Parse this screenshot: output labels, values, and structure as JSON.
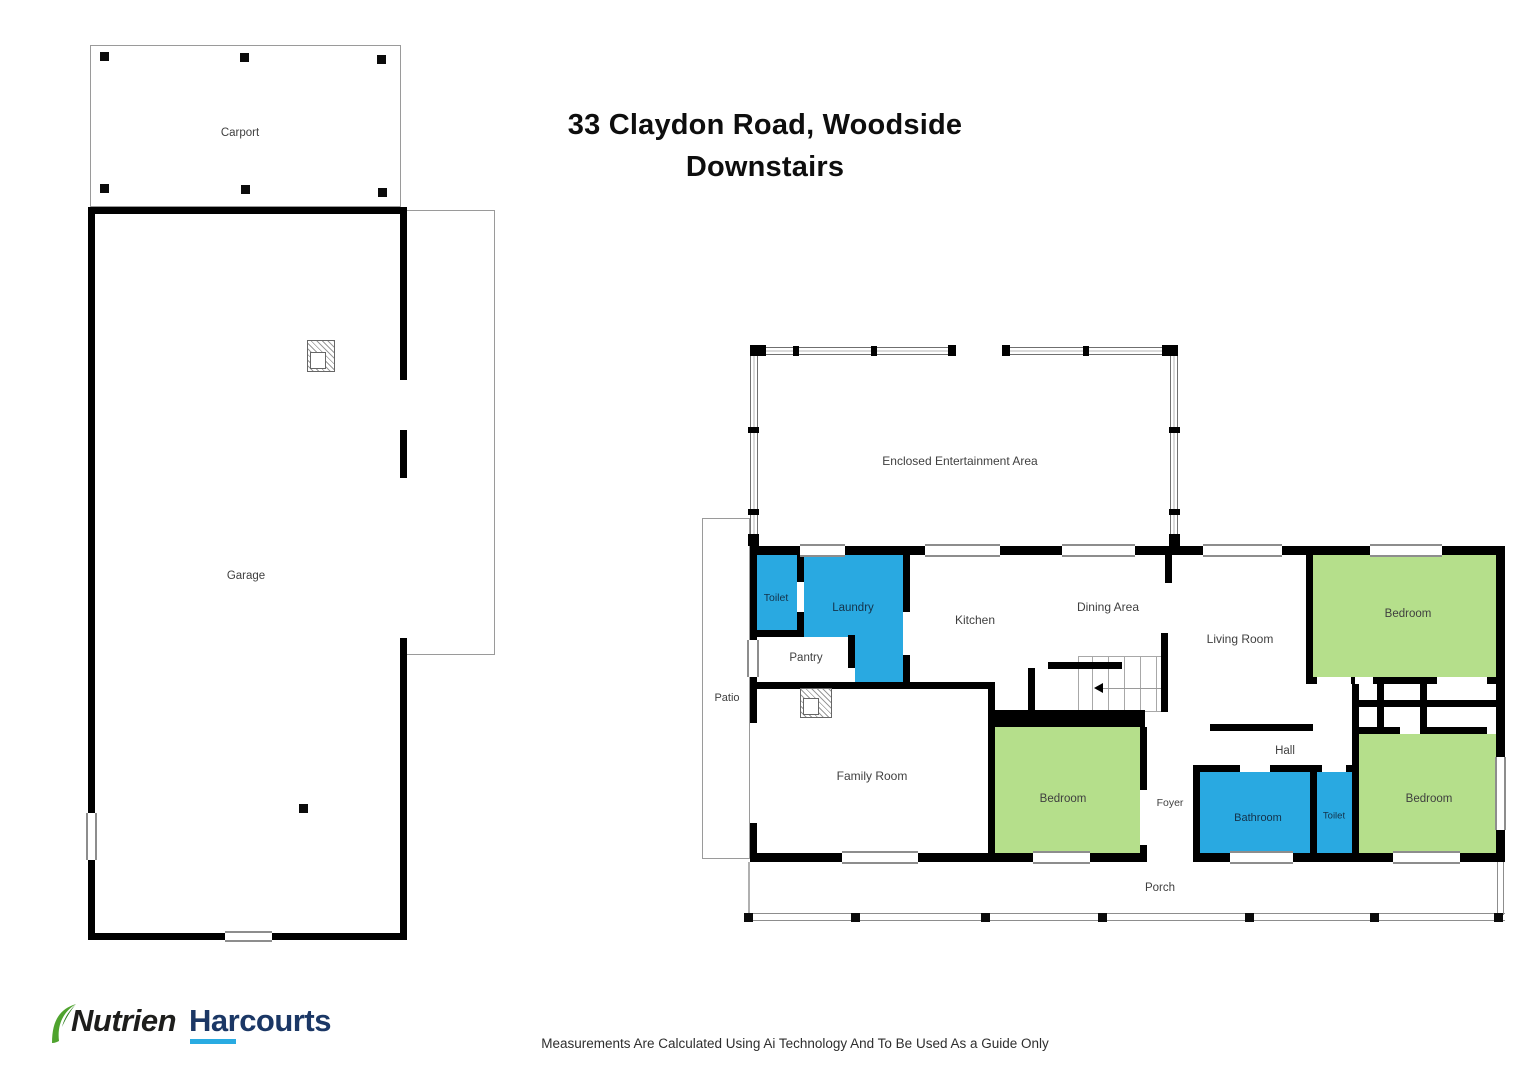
{
  "title": {
    "line1": "33 Claydon Road, Woodside",
    "line2": "Downstairs"
  },
  "rooms": {
    "carport": "Carport",
    "garage": "Garage",
    "entertainment": "Enclosed Entertainment Area",
    "toilet1": "Toilet",
    "laundry": "Laundry",
    "pantry": "Pantry",
    "kitchen": "Kitchen",
    "dining": "Dining Area",
    "living": "Living Room",
    "bedroom_top_right": "Bedroom",
    "patio": "Patio",
    "family": "Family Room",
    "bedroom_centre": "Bedroom",
    "foyer": "Foyer",
    "hall": "Hall",
    "bathroom": "Bathroom",
    "toilet2": "Toilet",
    "bedroom_bottom_right": "Bedroom",
    "porch": "Porch"
  },
  "colors": {
    "room_wet": "#29A9E1",
    "room_bedroom": "#B5DF8B",
    "wall": "#000000",
    "brand_dark": "#1E1E1C",
    "brand_navy": "#1B3765",
    "brand_green": "#4FA32E",
    "brand_cyan": "#29ABE2"
  },
  "logo": {
    "brand1": "Nutrien",
    "brand2": "Harcourts"
  },
  "footer": {
    "disclaimer": "Measurements Are Calculated Using Ai Technology And To Be Used As a Guide Only"
  }
}
